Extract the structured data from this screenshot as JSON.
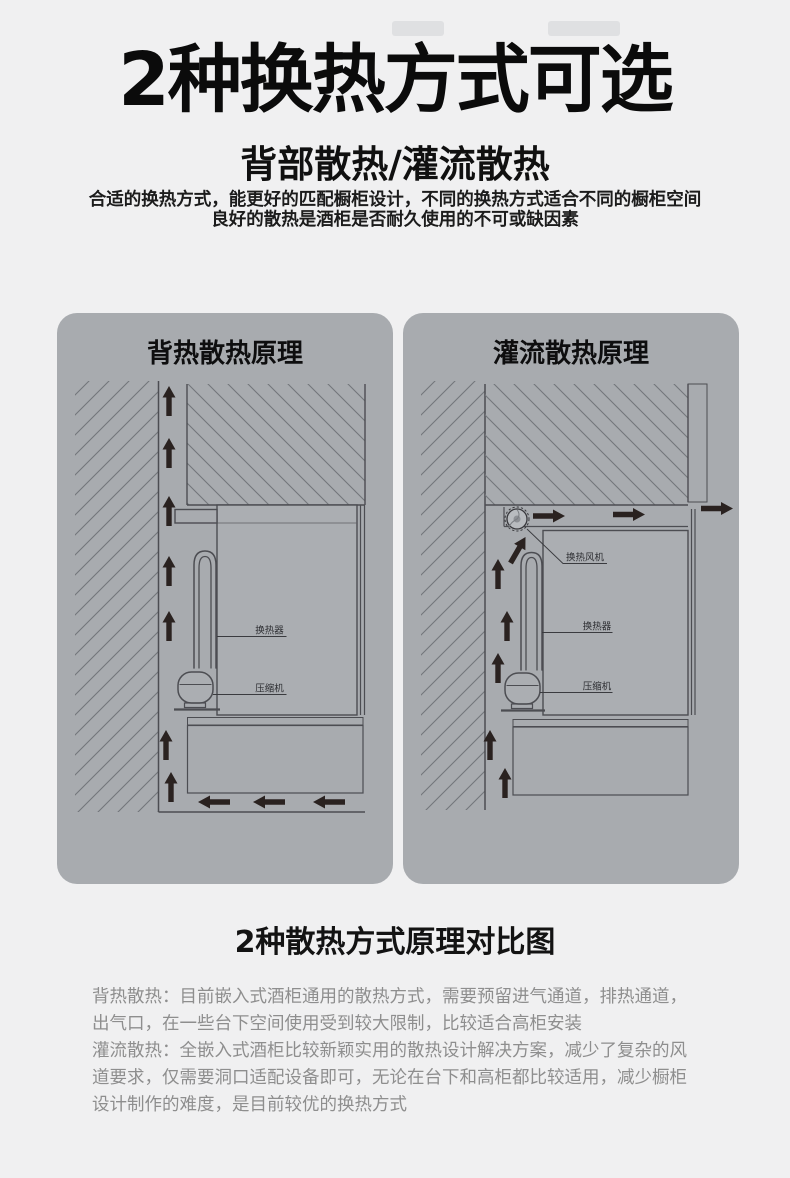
{
  "header": {
    "title": "2种换热方式可选",
    "subtitle": "背部散热/灌流散热",
    "intro_line1": "合适的换热方式，能更好的匹配橱柜设计，不同的换热方式适合不同的橱柜空间",
    "intro_line2": "良好的散热是酒柜是否耐久使用的不可或缺因素"
  },
  "panels": [
    {
      "title": "背热散热原理",
      "labels": {
        "heat_exchanger": "换热器",
        "compressor": "压缩机"
      }
    },
    {
      "title": "灌流散热原理",
      "labels": {
        "fan": "换热风机",
        "heat_exchanger": "换热器",
        "compressor": "压缩机"
      }
    }
  ],
  "comparison": {
    "heading": "2种散热方式原理对比图",
    "paragraphs": [
      "背热散热：目前嵌入式酒柜通用的散热方式，需要预留进气通道，排热通道，出气口，在一些台下空间使用受到较大限制，比较适合高柜安装",
      "灌流散热：全嵌入式酒柜比较新颖实用的散热设计解决方案，减少了复杂的风道要求，仅需要洞口适配设备即可，无论在台下和高柜都比较适用，减少橱柜设计制作的难度，是目前较优的换热方式"
    ]
  },
  "colors": {
    "page_background": "#f0f0f1",
    "panel_background": "#a8abaf",
    "line": "#4c4d52",
    "hatch": "#73767b",
    "arrow": "#2a2220",
    "title_text": "#0b0b0b",
    "body_text": "#8e8e8e"
  }
}
